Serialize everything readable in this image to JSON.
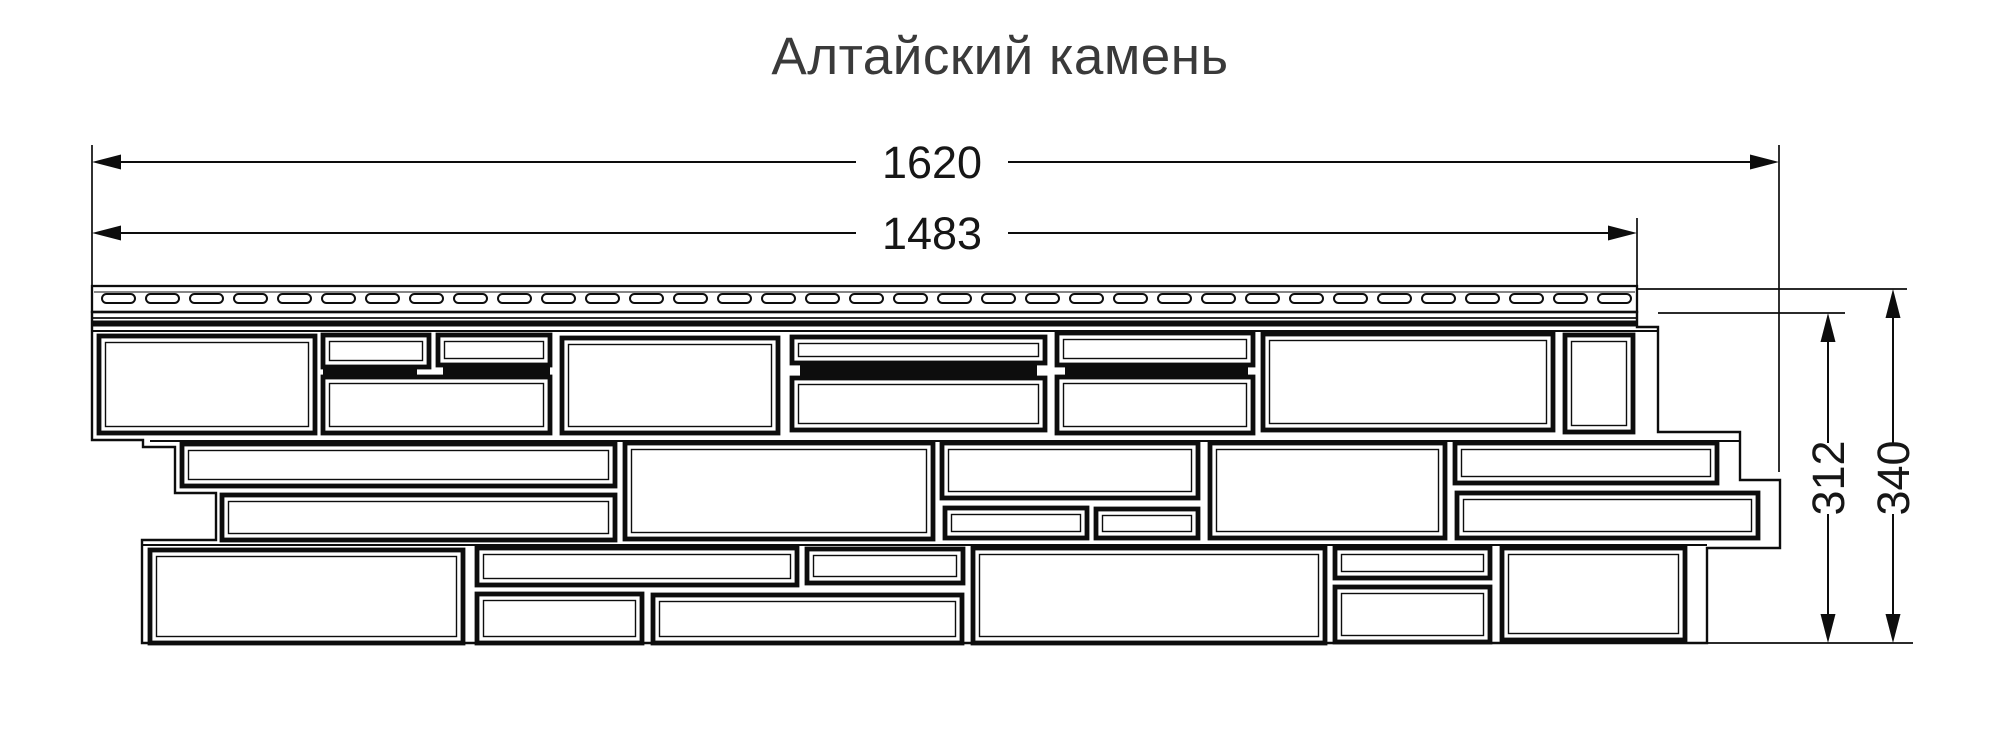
{
  "title": {
    "text": "Алтайский камень"
  },
  "colors": {
    "ink": "#0d0d0d",
    "title": "#3a3a3a",
    "background": "#ffffff"
  },
  "canvas": {
    "width": 2000,
    "height": 750
  },
  "dimensions": {
    "horizontal": [
      {
        "id": "dim-1620",
        "label": "1620",
        "y": 162,
        "x1": 92,
        "x2": 1779,
        "gap_x1": 856,
        "gap_x2": 1008,
        "label_x": 932,
        "label_y": 178
      },
      {
        "id": "dim-1483",
        "label": "1483",
        "y": 233,
        "x1": 92,
        "x2": 1637,
        "gap_x1": 856,
        "gap_x2": 1008,
        "label_x": 932,
        "label_y": 249
      }
    ],
    "vertical": [
      {
        "id": "dim-312",
        "label": "312",
        "x": 1828,
        "y1": 313,
        "y2": 643,
        "gap_y1": 443,
        "gap_y2": 514,
        "label_x": 1844,
        "label_y": 478
      },
      {
        "id": "dim-340",
        "label": "340",
        "x": 1893,
        "y1": 289,
        "y2": 643,
        "gap_y1": 443,
        "gap_y2": 514,
        "label_x": 1909,
        "label_y": 478
      }
    ]
  },
  "extension_lines": [
    {
      "x1": 92,
      "y1": 145,
      "x2": 92,
      "y2": 288
    },
    {
      "x1": 1779,
      "y1": 145,
      "x2": 1779,
      "y2": 472
    },
    {
      "x1": 1637,
      "y1": 218,
      "x2": 1637,
      "y2": 288
    },
    {
      "x1": 1637,
      "y1": 289,
      "x2": 1907,
      "y2": 289
    },
    {
      "x1": 1658,
      "y1": 313,
      "x2": 1845,
      "y2": 313
    },
    {
      "x1": 1707,
      "y1": 643,
      "x2": 1913,
      "y2": 643
    }
  ],
  "panel": {
    "strip": {
      "x": 92,
      "y": 286,
      "width": 1545,
      "height": 26
    },
    "strip_inner_line": {
      "x1": 94,
      "y": 292,
      "x2": 1635
    },
    "slots": {
      "start_x": 102,
      "pitch": 44,
      "count": 35,
      "y": 294,
      "width": 33,
      "height": 9,
      "radius": 4.5
    },
    "fold_line": {
      "x1": 92,
      "y": 318,
      "x2": 1637
    },
    "shadow_band": {
      "x": 92,
      "y": 320.5,
      "width": 1545,
      "height": 6
    },
    "face_top_line": {
      "x1": 91,
      "y": 331,
      "x2": 1658
    },
    "row_lines": [
      {
        "x1": 150,
        "y": 441,
        "x2": 1740
      },
      {
        "x1": 142,
        "y": 545,
        "x2": 1707
      }
    ],
    "outline_path": "M 92 312 L 92 440 L 143 440 L 143 447 L 175 447 L 175 493 L 216 493 L 216 540 L 142 540 L 142 643 L 1707 643 L 1707 548 L 1780 548 L 1780 480 L 1740 480 L 1740 432 L 1658 432 L 1658 327 L 1637 327 L 1637 312 Z",
    "stones": [
      {
        "x": 99,
        "y": 336,
        "w": 216,
        "h": 97
      },
      {
        "x": 323,
        "y": 335,
        "w": 106,
        "h": 32
      },
      {
        "x": 438,
        "y": 335,
        "w": 112,
        "h": 30
      },
      {
        "x": 323,
        "y": 377,
        "w": 227,
        "h": 56
      },
      {
        "x": 562,
        "y": 338,
        "w": 216,
        "h": 95
      },
      {
        "x": 792,
        "y": 337,
        "w": 253,
        "h": 26
      },
      {
        "x": 792,
        "y": 378,
        "w": 253,
        "h": 52
      },
      {
        "x": 1057,
        "y": 333,
        "w": 196,
        "h": 32
      },
      {
        "x": 1057,
        "y": 377,
        "w": 196,
        "h": 56
      },
      {
        "x": 1263,
        "y": 334,
        "w": 290,
        "h": 96
      },
      {
        "x": 1565,
        "y": 335,
        "w": 68,
        "h": 97
      },
      {
        "x": 182,
        "y": 444,
        "w": 433,
        "h": 42
      },
      {
        "x": 222,
        "y": 495,
        "w": 393,
        "h": 45
      },
      {
        "x": 625,
        "y": 443,
        "w": 308,
        "h": 96
      },
      {
        "x": 942,
        "y": 443,
        "w": 256,
        "h": 55
      },
      {
        "x": 945,
        "y": 508,
        "w": 142,
        "h": 30
      },
      {
        "x": 1096,
        "y": 509,
        "w": 102,
        "h": 29
      },
      {
        "x": 1210,
        "y": 443,
        "w": 235,
        "h": 95
      },
      {
        "x": 1455,
        "y": 443,
        "w": 262,
        "h": 40
      },
      {
        "x": 1457,
        "y": 493,
        "w": 301,
        "h": 45
      },
      {
        "x": 150,
        "y": 550,
        "w": 313,
        "h": 93
      },
      {
        "x": 477,
        "y": 548,
        "w": 320,
        "h": 37
      },
      {
        "x": 477,
        "y": 594,
        "w": 165,
        "h": 49
      },
      {
        "x": 807,
        "y": 549,
        "w": 156,
        "h": 34
      },
      {
        "x": 653,
        "y": 595,
        "w": 309,
        "h": 48
      },
      {
        "x": 973,
        "y": 548,
        "w": 352,
        "h": 95
      },
      {
        "x": 1335,
        "y": 548,
        "w": 155,
        "h": 30
      },
      {
        "x": 1335,
        "y": 587,
        "w": 155,
        "h": 55
      },
      {
        "x": 1502,
        "y": 548,
        "w": 183,
        "h": 92
      }
    ],
    "black_bands": [
      {
        "x": 323,
        "y": 366,
        "w": 94,
        "h": 12
      },
      {
        "x": 443,
        "y": 366,
        "w": 107,
        "h": 12
      },
      {
        "x": 800,
        "y": 365,
        "w": 237,
        "h": 12
      },
      {
        "x": 1065,
        "y": 366,
        "w": 183,
        "h": 12
      }
    ]
  }
}
